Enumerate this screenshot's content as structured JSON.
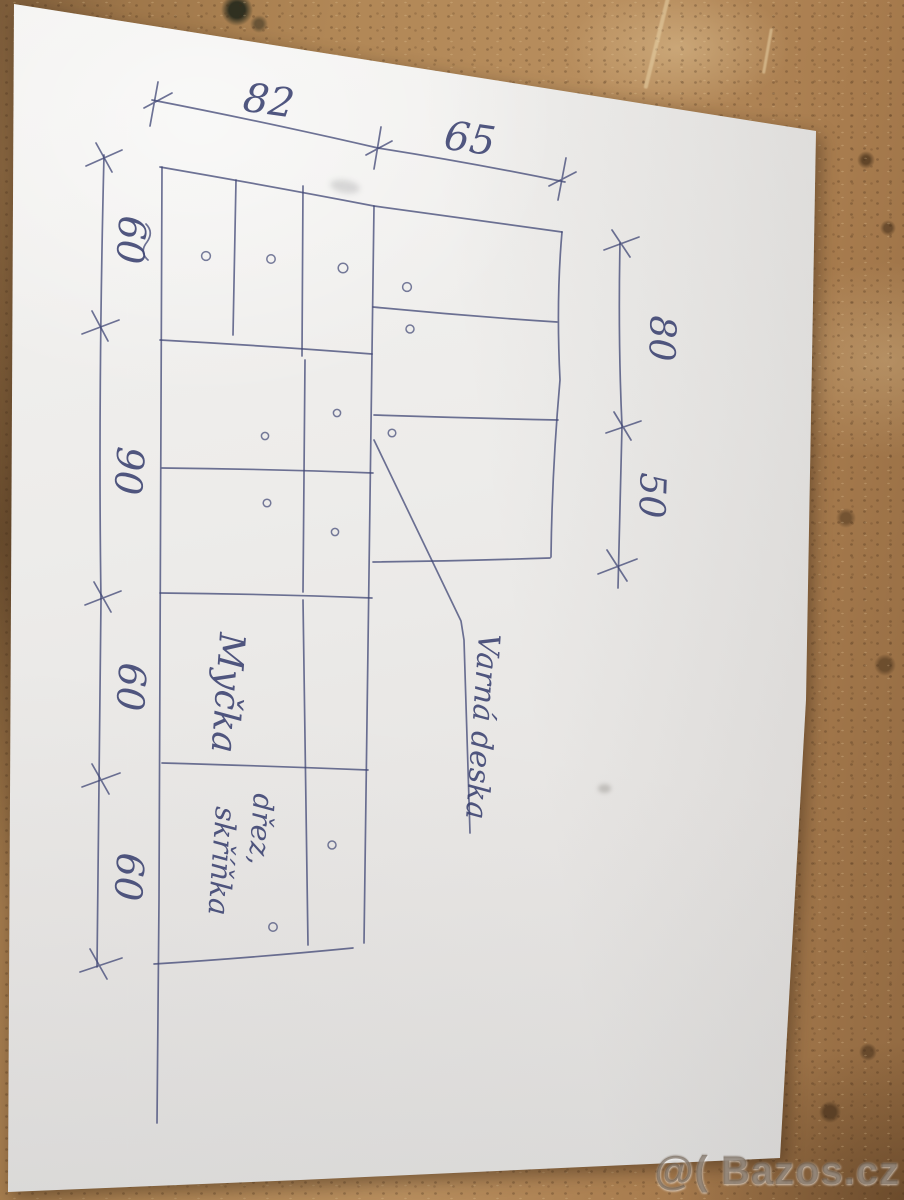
{
  "sketch": {
    "dim_top": [
      "82",
      "65"
    ],
    "dim_left": [
      "60",
      "90",
      "60",
      "60"
    ],
    "dim_right": [
      "80",
      "50"
    ],
    "labels": {
      "dishwasher": "Myčka",
      "sink_line1": "dřez,",
      "sink_line2": "skříňka",
      "cooktop": "Varná deska"
    }
  },
  "watermark": {
    "text": "@( Bazos.cz"
  },
  "colors": {
    "pen": "#3f4674",
    "paper": "#eceae7",
    "cork": "#a87c4f"
  }
}
